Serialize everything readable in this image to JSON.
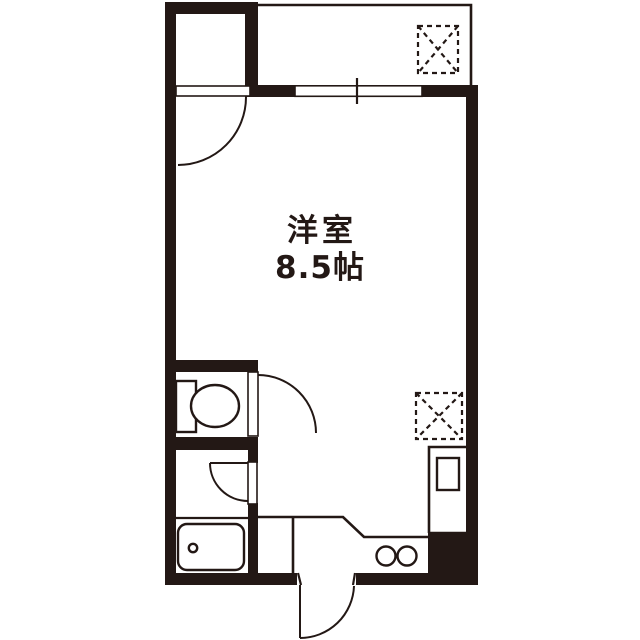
{
  "floorplan": {
    "room_label": "洋室",
    "room_size_label": "8.5帖",
    "colors": {
      "ink": "#231815",
      "background": "#ffffff"
    }
  }
}
